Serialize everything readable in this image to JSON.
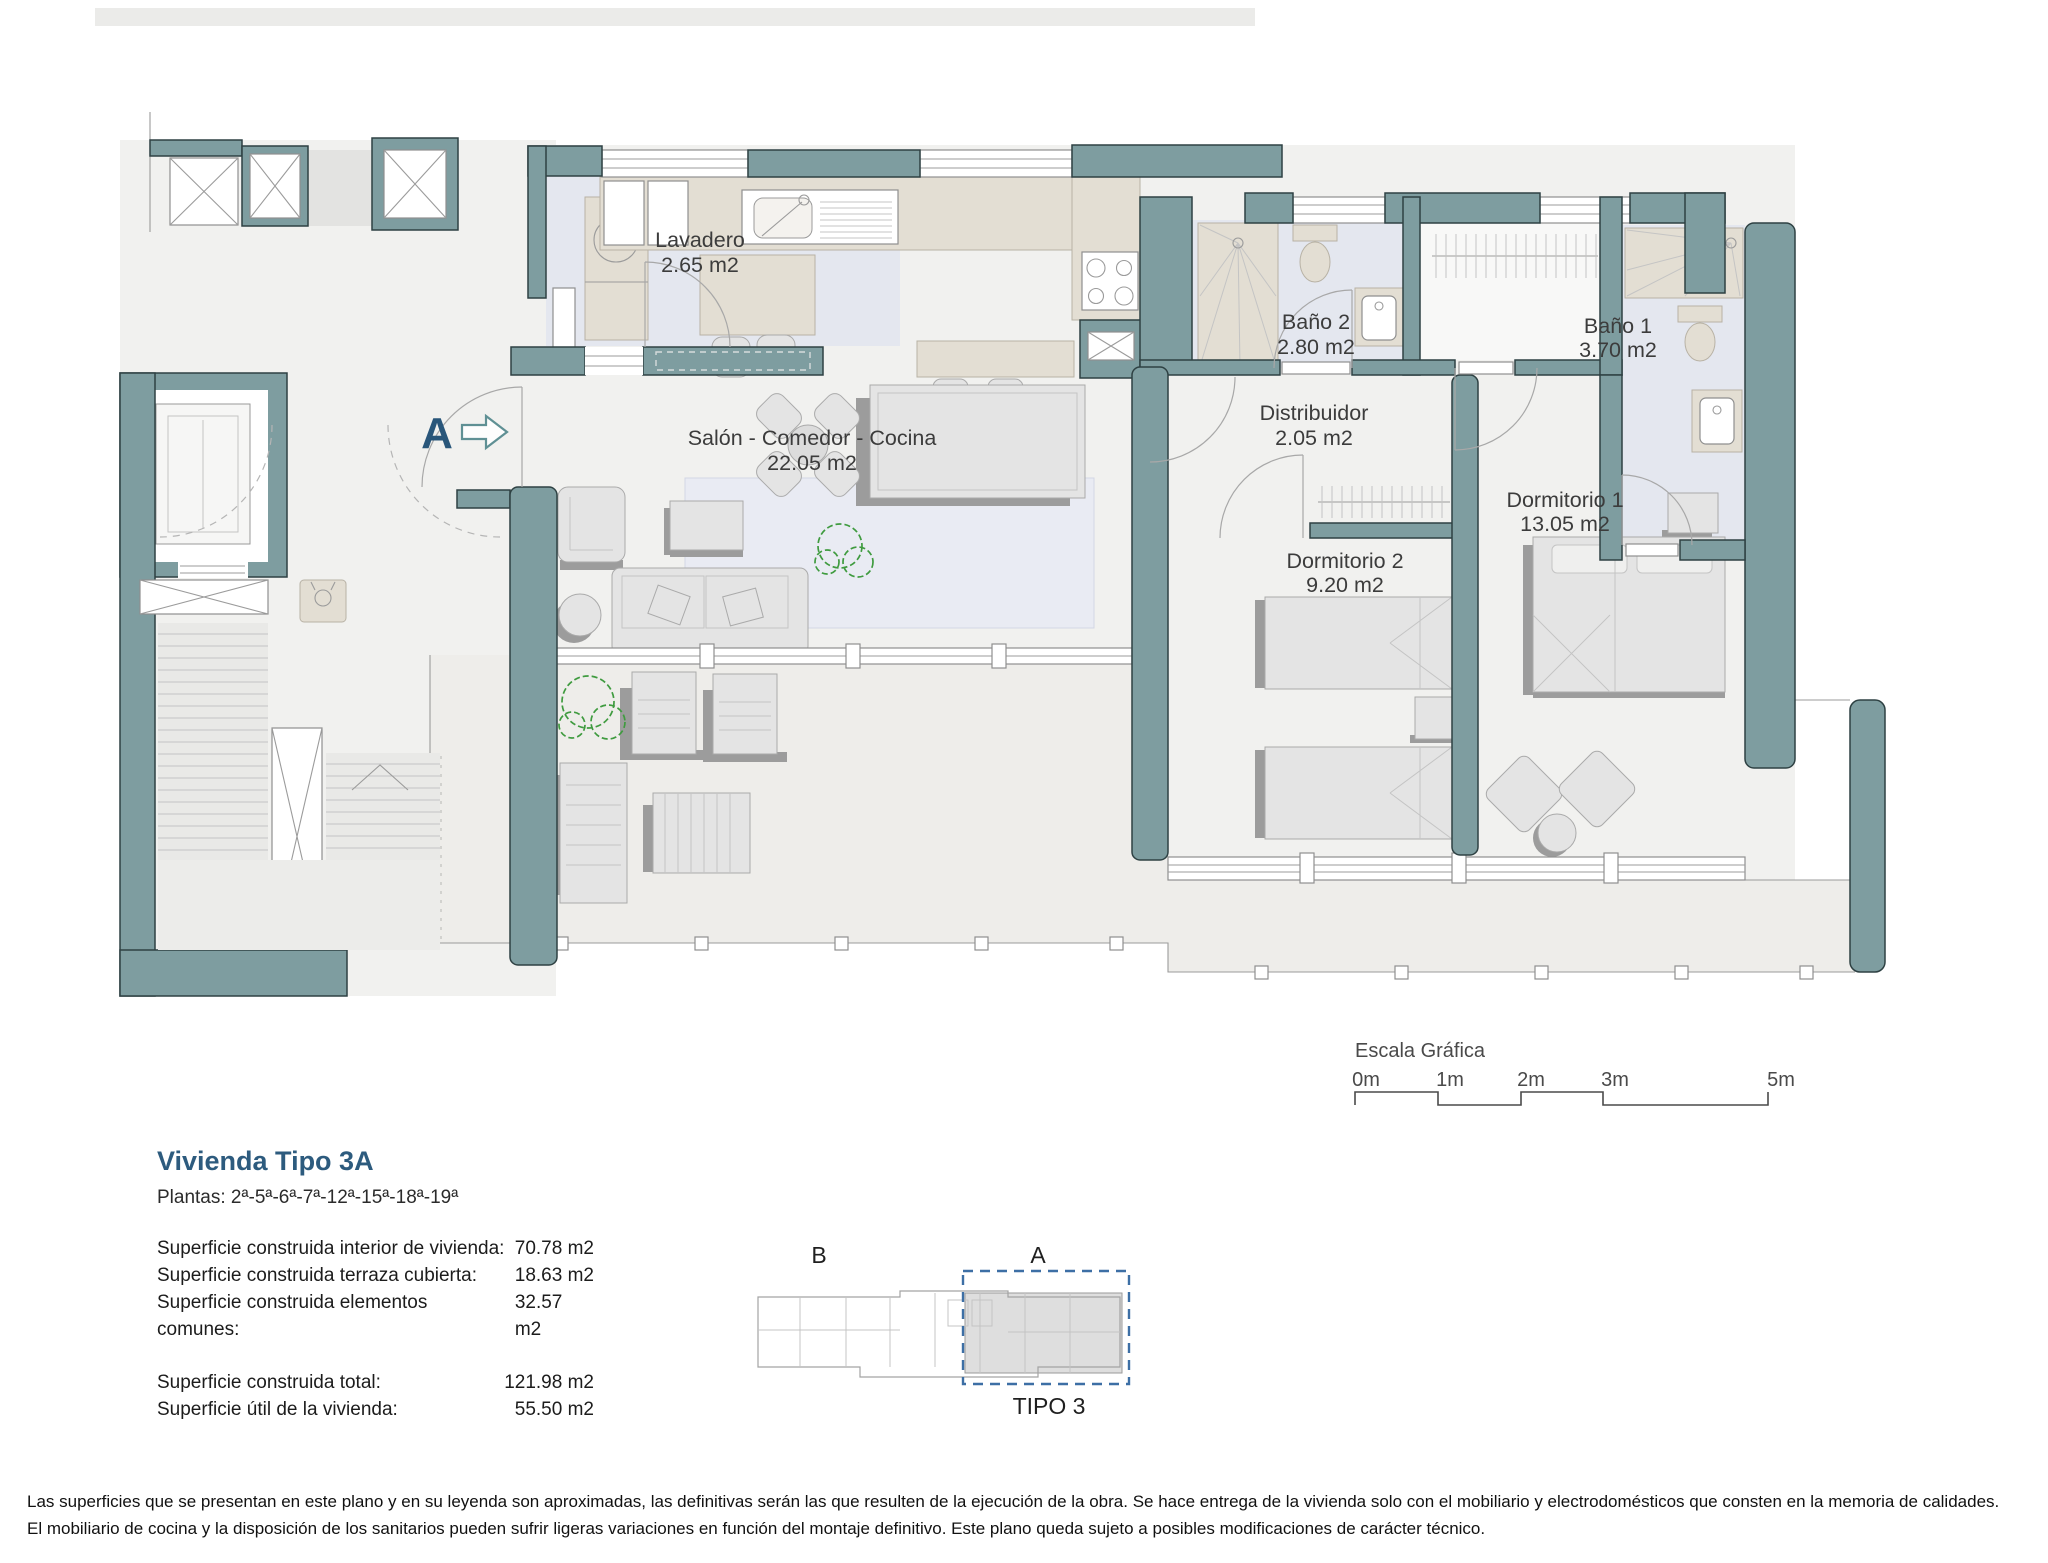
{
  "plan": {
    "section_marker": "A",
    "rooms": [
      {
        "name": "Lavadero",
        "area": "2.65 m2"
      },
      {
        "name": "Salón - Comedor - Cocina",
        "area": "22.05 m2"
      },
      {
        "name": "Baño 2",
        "area": "2.80 m2"
      },
      {
        "name": "Distribuidor",
        "area": "2.05 m2"
      },
      {
        "name": "Baño 1",
        "area": "3.70 m2"
      },
      {
        "name": "Dormitorio 2",
        "area": "9.20 m2"
      },
      {
        "name": "Dormitorio 1",
        "area": "13.05 m2"
      }
    ]
  },
  "scale_bar": {
    "title": "Escala Gráfica",
    "ticks": [
      "0m",
      "1m",
      "2m",
      "3m",
      "5m"
    ]
  },
  "legend": {
    "title": "Vivienda Tipo 3A",
    "plantas": "Plantas: 2ª-5ª-6ª-7ª-12ª-15ª-18ª-19ª",
    "rows": [
      {
        "label": "Superficie construida interior de vivienda:",
        "value": "70.78 m2"
      },
      {
        "label": "Superficie construida terraza cubierta:",
        "value": "18.63 m2"
      },
      {
        "label": "Superficie construida elementos comunes:",
        "value": "32.57 m2"
      }
    ],
    "totals": [
      {
        "label": "Superficie construida total:",
        "value": "121.98 m2"
      },
      {
        "label": "Superficie útil de la vivienda:",
        "value": "55.50 m2"
      }
    ]
  },
  "key_plan": {
    "block_b": "B",
    "block_a": "A",
    "caption": "TIPO 3"
  },
  "footer": {
    "line1": "Las superficies que se presentan en este plano y en su leyenda son aproximadas, las definitivas serán las que resulten de la ejecución de la obra. Se hace entrega de la vivienda solo con el mobiliario y electrodomésticos que consten en la memoria de calidades.",
    "line2": "El mobiliario de cocina y la disposición de los sanitarios pueden sufrir ligeras variaciones en función del montaje definitivo. Este plano queda sujeto a posibles modificaciones de carácter técnico."
  },
  "colors": {
    "wall": "#7e9da0",
    "title_blue": "#2d5b7e",
    "keyplan_dash": "#3d6fa5",
    "plant_green": "#3f9b3f"
  }
}
